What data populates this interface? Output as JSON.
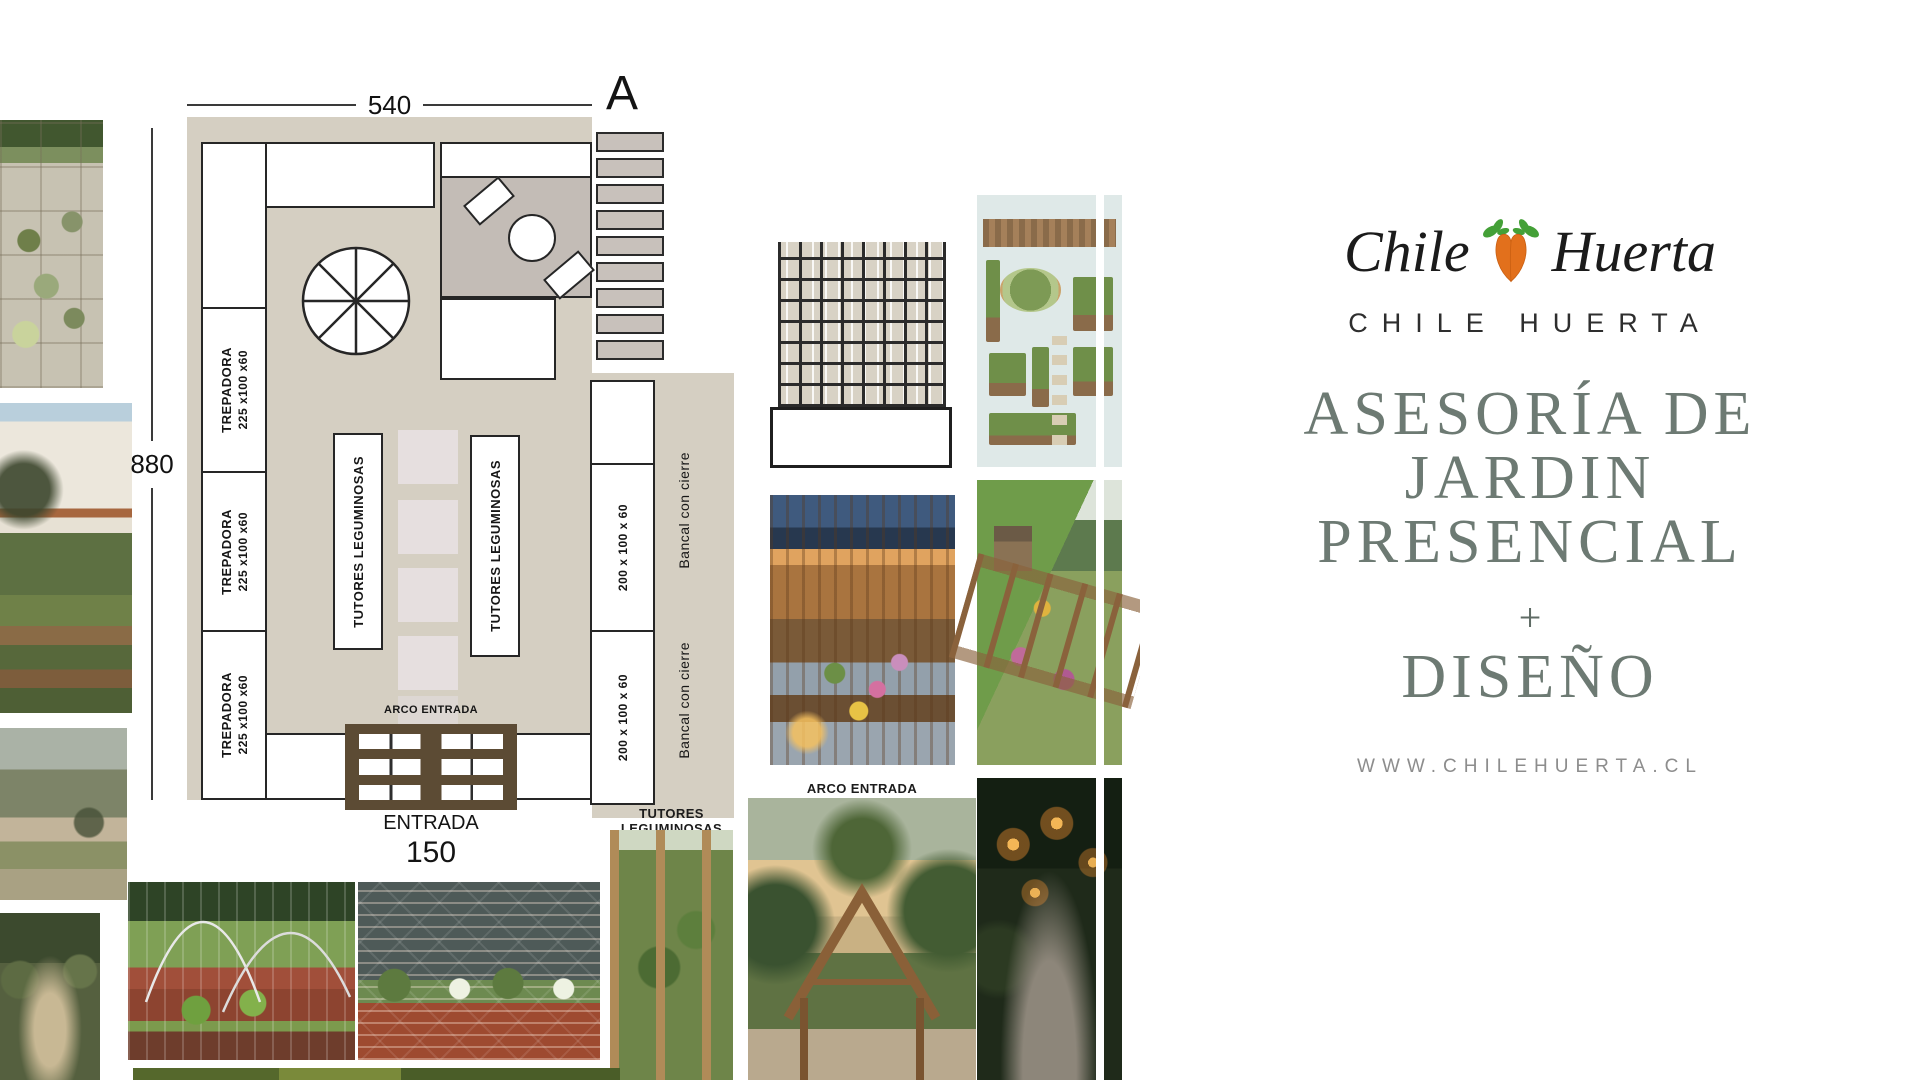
{
  "colors": {
    "plan_beige": "#d5cfc2",
    "plan_outline": "#262626",
    "patio_gray": "#c3bcb6",
    "bed_square_pink": "#e6dfdf",
    "slat_gray": "#c8c1bb",
    "pallet_brown": "#5c4b34",
    "title_green": "#6d7a73",
    "brand_dark": "#2e2e2e",
    "website_gray": "#8d8d8d",
    "carrot_orange": "#e2701c",
    "carrot_leaf_green": "#44a037"
  },
  "plan": {
    "dim_top": "540",
    "dim_left": "880",
    "dim_bottom": "150",
    "section_letter": "A",
    "entrance_label": "ENTRADA",
    "arch_label": "ARCO ENTRADA",
    "trepadora_label": "TREPADORA",
    "trepadora_size": "225 x100 x60",
    "tutores_label": "TUTORES LEGUMINOSAS",
    "bed_size_label": "200 x 100 x 60",
    "bancal_label": "Bancal con cierre"
  },
  "captions": {
    "tutores": "TUTORES LEGUMINOSAS",
    "arco": "ARCO ENTRADA"
  },
  "brand": {
    "logo_script_left": "Chile",
    "logo_script_right": "Huerta",
    "name": "CHILE HUERTA",
    "title1": "ASESORÍA DE",
    "title2": "JARDIN",
    "title3": "PRESENCIAL",
    "title_plus": "+",
    "title4": "DISEÑO",
    "website": "WWW.CHILEHUERTA.CL"
  }
}
